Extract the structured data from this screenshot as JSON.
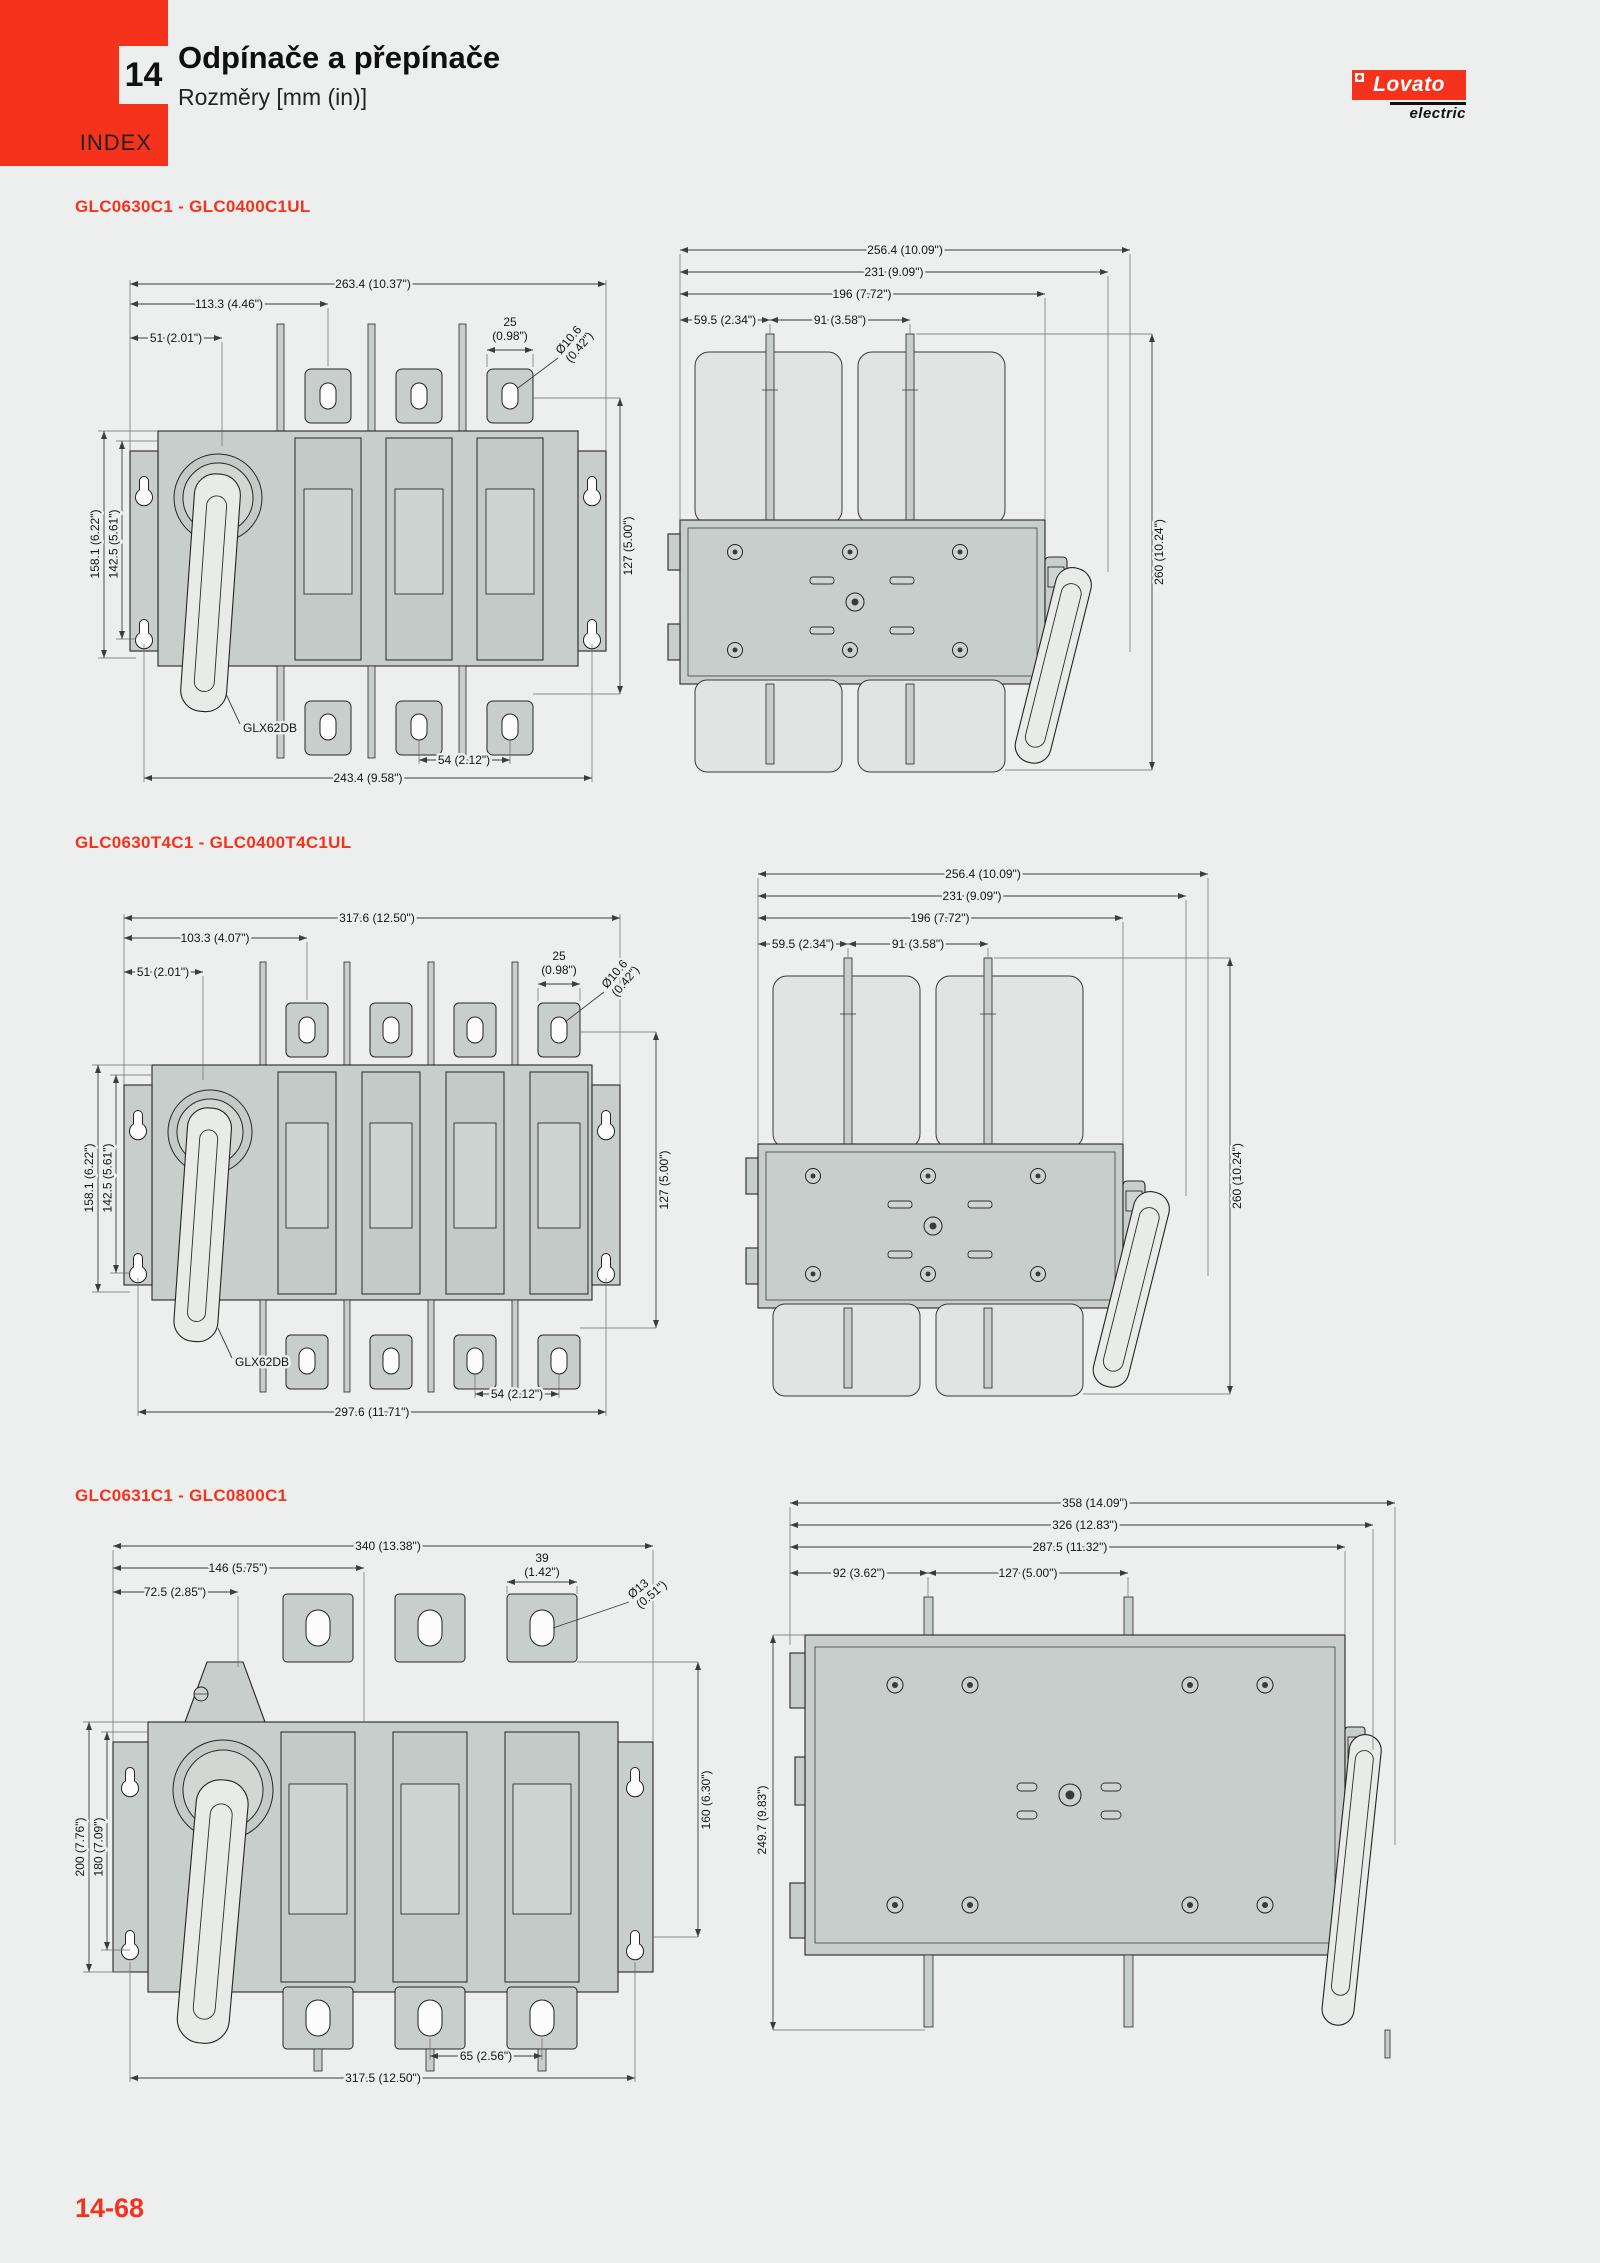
{
  "page": {
    "tab_number": "14",
    "index_label": "INDEX",
    "title": "Odpínače a přepínače",
    "subtitle": "Rozměry [mm (in)]",
    "page_number": "14-68",
    "accent_color": "#f5331d",
    "background_color": "#edefee",
    "logo": {
      "brand": "Lovato",
      "sub": "electric"
    }
  },
  "sections": [
    {
      "heading": "GLC0630C1 - GLC0400C1UL",
      "front": {
        "overall_width": "263.4 (10.37\")",
        "pole1_offset": "113.3 (4.46\")",
        "handle_offset": "51 (2.01\")",
        "tab_width": "25",
        "tab_width_in": "(0.98\")",
        "hole_dia": "Ø10.6",
        "hole_dia_in": "(0.42\")",
        "height_overall": "158.1 (6.22\")",
        "height_mounting": "142.5 (5.61\")",
        "terminal_span": "127 (5.00\")",
        "handle_part": "GLX62DB",
        "pole_pitch": "54 (2.12\")",
        "mounting_width": "243.4 (9.58\")"
      },
      "top": {
        "depth_overall": "256.4 (10.09\")",
        "depth_handle": "231 (9.09\")",
        "depth_body": "196 (7.72\")",
        "pad_offset": "59.5 (2.34\")",
        "pad_pitch": "91 (3.58\")",
        "width_overall": "260 (10.24\")"
      }
    },
    {
      "heading": "GLC0630T4C1 - GLC0400T4C1UL",
      "front": {
        "overall_width": "317.6 (12.50\")",
        "pole1_offset": "103.3 (4.07\")",
        "handle_offset": "51 (2.01\")",
        "tab_width": "25",
        "tab_width_in": "(0.98\")",
        "hole_dia": "Ø10.6",
        "hole_dia_in": "(0.42\")",
        "height_overall": "158.1 (6.22\")",
        "height_mounting": "142.5 (5.61\")",
        "terminal_span": "127 (5.00\")",
        "handle_part": "GLX62DB",
        "pole_pitch": "54 (2.12\")",
        "mounting_width": "297.6 (11.71\")"
      },
      "top": {
        "depth_overall": "256.4 (10.09\")",
        "depth_handle": "231 (9.09\")",
        "depth_body": "196 (7.72\")",
        "pad_offset": "59.5 (2.34\")",
        "pad_pitch": "91 (3.58\")",
        "width_overall": "260 (10.24\")"
      }
    },
    {
      "heading": "GLC0631C1 - GLC0800C1",
      "front": {
        "overall_width": "340 (13.38\")",
        "pole1_offset": "146 (5.75\")",
        "handle_offset": "72.5 (2.85\")",
        "tab_width": "39",
        "tab_width_in": "(1.42\")",
        "hole_dia": "Ø13",
        "hole_dia_in": "(0.51\")",
        "height_overall": "200 (7.76\")",
        "height_mounting": "180 (7.09\")",
        "terminal_span": "160 (6.30\")",
        "pole_pitch": "65 (2.56\")",
        "mounting_width": "317.5 (12.50\")"
      },
      "side": {
        "depth_overall": "358 (14.09\")",
        "depth_handle": "326 (12.83\")",
        "depth_body": "287.5 (11.32\")",
        "pad_offset": "92 (3.62\")",
        "pad_pitch": "127 (5.00\")",
        "width_overall": "249.7 (9.83\")"
      }
    }
  ]
}
